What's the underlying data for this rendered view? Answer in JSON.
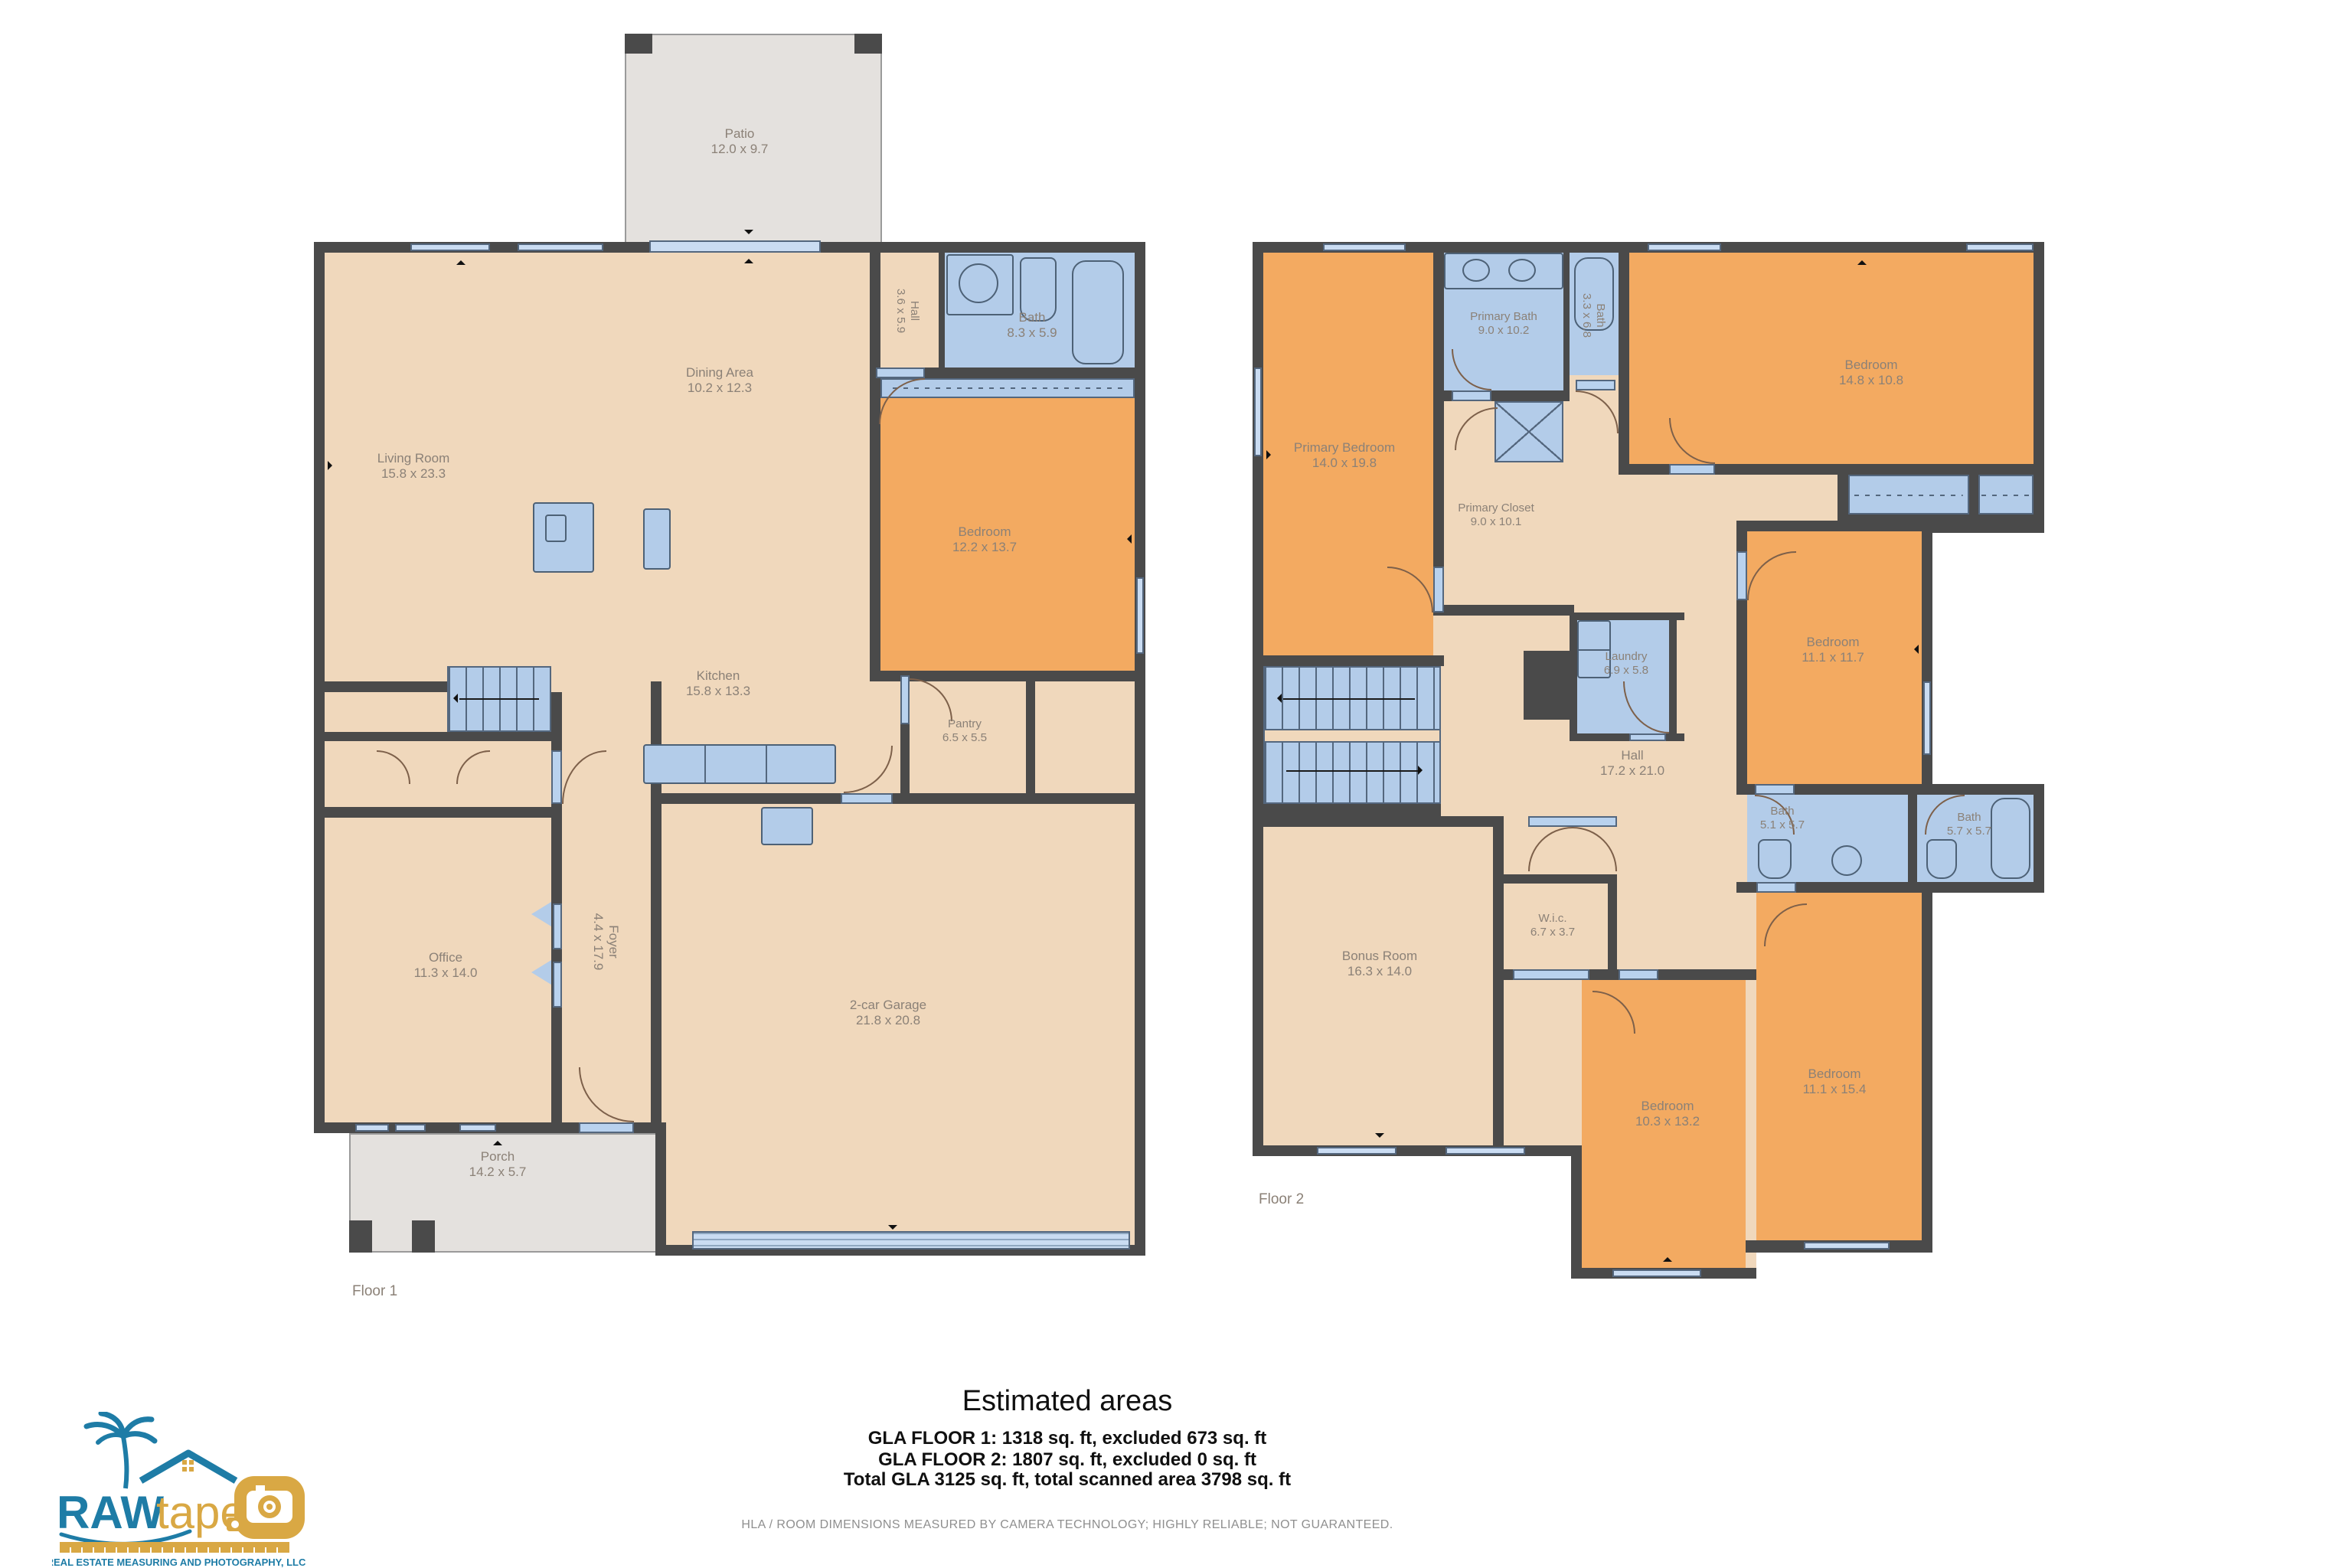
{
  "colors": {
    "floor_tan": "#f0d8bc",
    "room_orange": "#f3aa61",
    "wet_blue": "#b3cce9",
    "wall_dark": "#4a4a4a",
    "outdoor_gray": "#e4e1de",
    "label_gray": "#8b8177",
    "brand_blue": "#1e7ca6",
    "brand_gold": "#d9a844"
  },
  "floor1": {
    "label": "Floor 1",
    "rooms": {
      "patio": {
        "name": "Patio",
        "dims": "12.0 x 9.7"
      },
      "living": {
        "name": "Living Room",
        "dims": "15.8 x 23.3"
      },
      "dining": {
        "name": "Dining Area",
        "dims": "10.2 x 12.3"
      },
      "hall": {
        "name": "Hall",
        "dims": "3.6 x 5.9"
      },
      "bath": {
        "name": "Bath",
        "dims": "8.3 x 5.9"
      },
      "bedroom": {
        "name": "Bedroom",
        "dims": "12.2 x 13.7"
      },
      "kitchen": {
        "name": "Kitchen",
        "dims": "15.8 x 13.3"
      },
      "pantry": {
        "name": "Pantry",
        "dims": "6.5 x 5.5"
      },
      "office": {
        "name": "Office",
        "dims": "11.3 x 14.0"
      },
      "foyer": {
        "name": "Foyer",
        "dims": "4.4 x 17.9"
      },
      "garage": {
        "name": "2-car Garage",
        "dims": "21.8 x 20.8"
      },
      "porch": {
        "name": "Porch",
        "dims": "14.2 x 5.7"
      }
    }
  },
  "floor2": {
    "label": "Floor 2",
    "rooms": {
      "primary_bedroom": {
        "name": "Primary Bedroom",
        "dims": "14.0 x 19.8"
      },
      "primary_bath": {
        "name": "Primary Bath",
        "dims": "9.0 x 10.2"
      },
      "bath_upper": {
        "name": "Bath",
        "dims": "3.3 x 6.8"
      },
      "bedroom_tr": {
        "name": "Bedroom",
        "dims": "14.8 x 10.8"
      },
      "primary_closet": {
        "name": "Primary Closet",
        "dims": "9.0 x 10.1"
      },
      "laundry": {
        "name": "Laundry",
        "dims": "6.9 x 5.8"
      },
      "bedroom_mid": {
        "name": "Bedroom",
        "dims": "11.1 x 11.7"
      },
      "hall": {
        "name": "Hall",
        "dims": "17.2 x 21.0"
      },
      "bath1": {
        "name": "Bath",
        "dims": "5.1 x 5.7"
      },
      "bath2": {
        "name": "Bath",
        "dims": "5.7 x 5.7"
      },
      "wic": {
        "name": "W.i.c.",
        "dims": "6.7 x 3.7"
      },
      "bonus": {
        "name": "Bonus Room",
        "dims": "16.3 x 14.0"
      },
      "bedroom_bl": {
        "name": "Bedroom",
        "dims": "10.3 x 13.2"
      },
      "bedroom_br": {
        "name": "Bedroom",
        "dims": "11.1 x 15.4"
      }
    }
  },
  "summary": {
    "title": "Estimated areas",
    "lines": [
      "GLA FLOOR 1: 1318 sq. ft, excluded 673 sq. ft",
      "GLA FLOOR 2: 1807 sq. ft, excluded 0 sq. ft",
      "Total GLA 3125 sq. ft, total scanned area 3798 sq. ft"
    ]
  },
  "disclaimer": "HLA / ROOM DIMENSIONS MEASURED BY CAMERA TECHNOLOGY; HIGHLY RELIABLE; NOT GUARANTEED.",
  "logo": {
    "brand_primary": "RAW",
    "brand_secondary": "tape",
    "tagline": "REAL ESTATE MEASURING AND PHOTOGRAPHY, LLC"
  }
}
